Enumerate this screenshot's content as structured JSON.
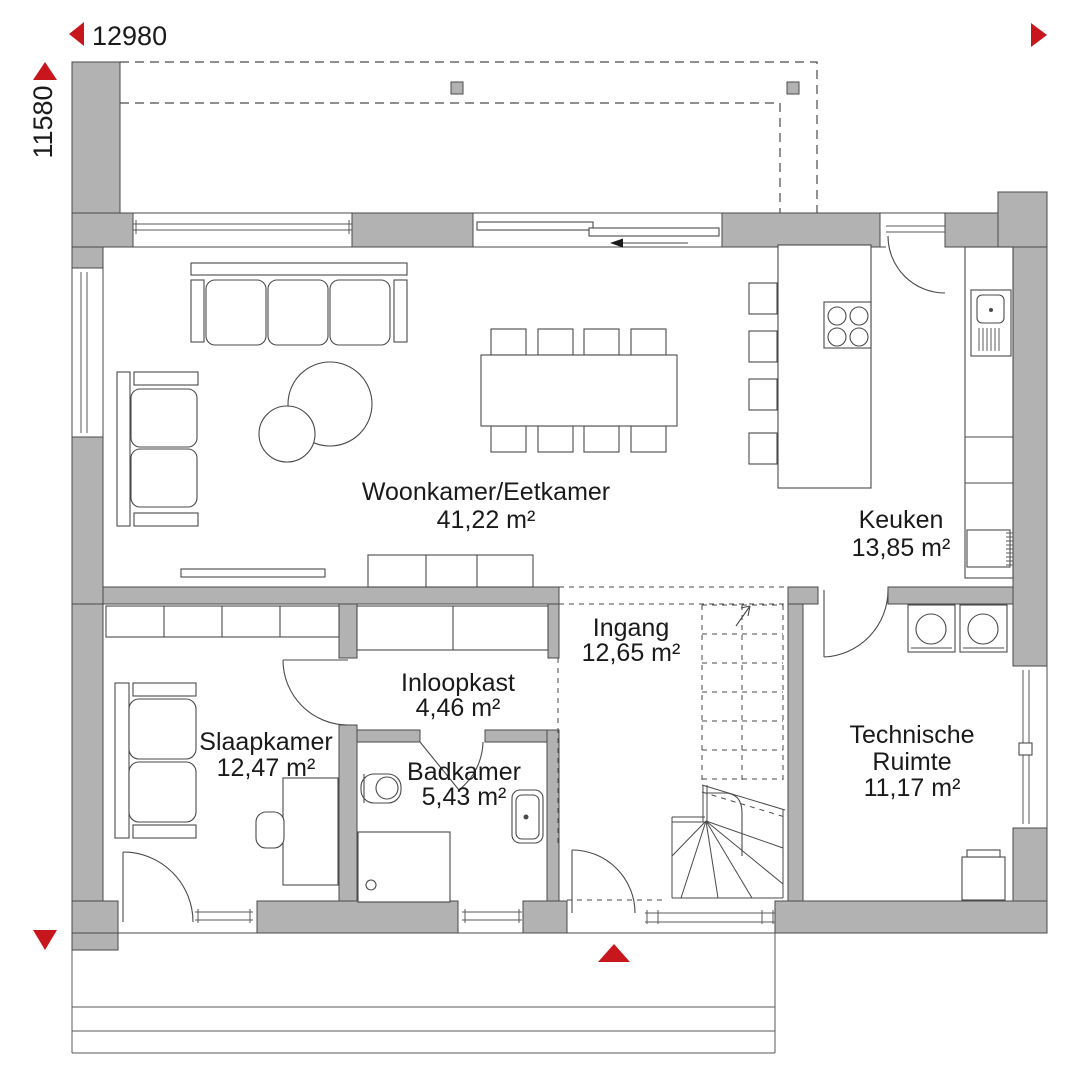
{
  "dimensions": {
    "width_label": "12980",
    "height_label": "11580"
  },
  "rooms": [
    {
      "id": "woonkamer-eetkamer",
      "name": "Woonkamer/Eetkamer",
      "area": "41,22 m²"
    },
    {
      "id": "keuken",
      "name": "Keuken",
      "area": "13,85 m²"
    },
    {
      "id": "ingang",
      "name": "Ingang",
      "area": "12,65 m²"
    },
    {
      "id": "inloopkast",
      "name": "Inloopkast",
      "area": "4,46 m²"
    },
    {
      "id": "slaapkamer",
      "name": "Slaapkamer",
      "area": "12,47 m²"
    },
    {
      "id": "badkamer",
      "name": "Badkamer",
      "area": "5,43 m²"
    },
    {
      "id": "technische-ruimte",
      "name": "Technische Ruimte",
      "name_lines": [
        "Technische",
        "Ruimte"
      ],
      "area": "11,17 m²"
    }
  ],
  "markers": {
    "entrance_marker": "red-up-triangle",
    "dimension_arrows": [
      "left",
      "right",
      "up",
      "down"
    ],
    "sliding_door_direction": "left",
    "stairs_direction": "up"
  },
  "colors": {
    "wall_fill": "#b2b2b2",
    "line": "#4a4a4a",
    "accent_red": "#c8171c",
    "text": "#1a1a1a",
    "background": "#ffffff"
  }
}
